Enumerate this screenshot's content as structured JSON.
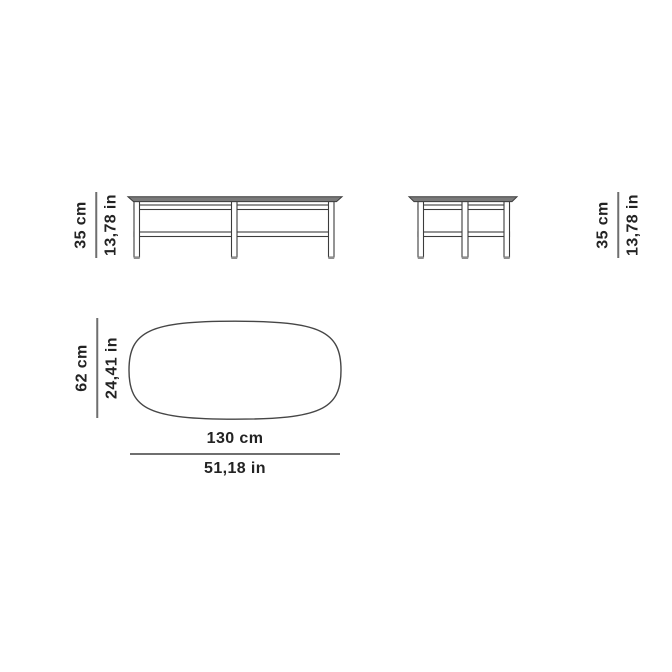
{
  "colors": {
    "background": "#ffffff",
    "text": "#232323",
    "dimension_line": "#6f6f6f",
    "drawing_outline": "#3c3c3c",
    "tabletop_fill": "#7a7a7a"
  },
  "dimensions": {
    "height_front": {
      "cm": "35 cm",
      "inches": "13,78 in"
    },
    "height_side": {
      "cm": "35 cm",
      "inches": "13,78 in"
    },
    "depth": {
      "cm": "62 cm",
      "inches": "24,41 in"
    },
    "width": {
      "cm": "130 cm",
      "inches": "51,18 in"
    }
  }
}
